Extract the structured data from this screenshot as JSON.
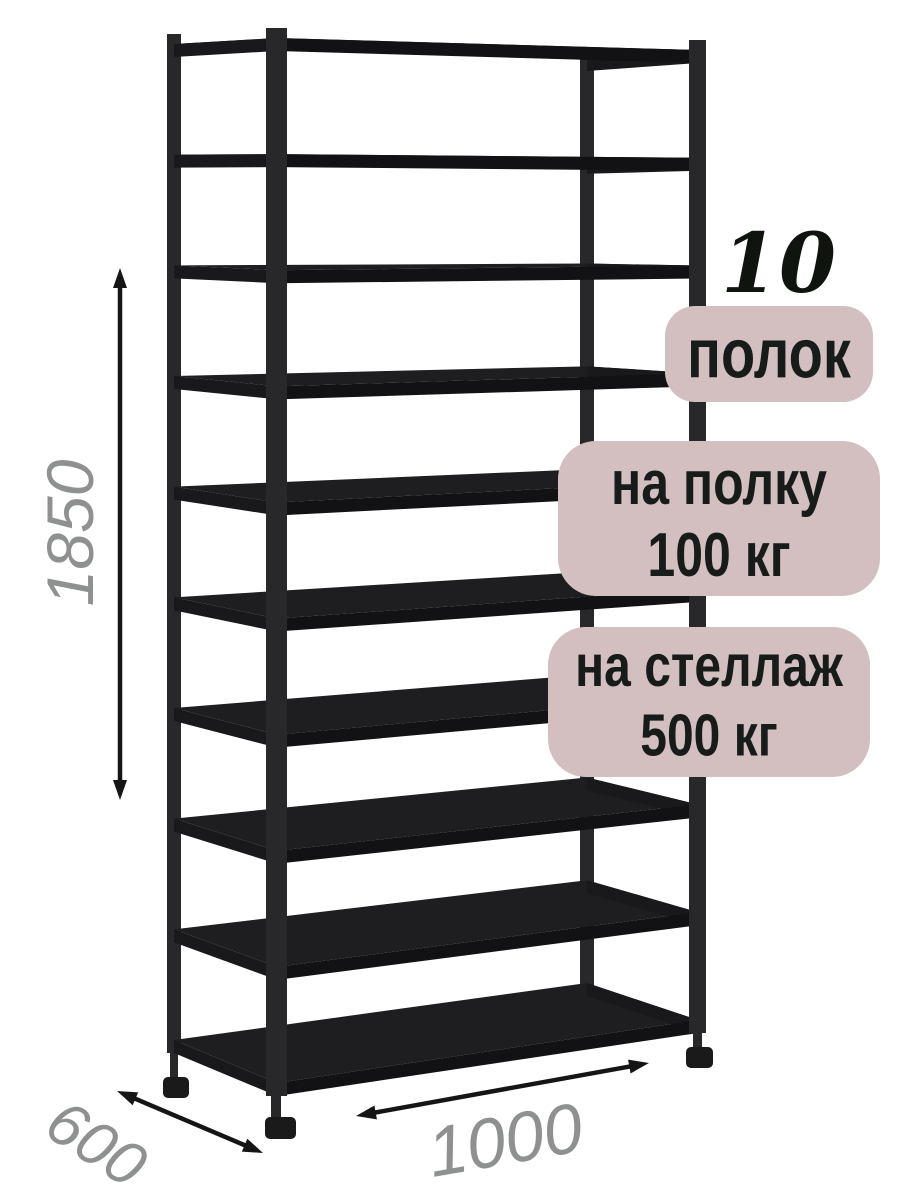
{
  "product": {
    "shelf_count": 10
  },
  "callouts": {
    "shelf_count_value": "10",
    "shelf_count_unit": "полок",
    "shelf_load": {
      "line1": "на полку",
      "line2": "100 кг"
    },
    "rack_load": {
      "line1": "на стеллаж",
      "line2": "500 кг"
    }
  },
  "dimensions": {
    "height": "1850",
    "depth": "600",
    "width": "1000"
  },
  "colors": {
    "background": "#ffffff",
    "badge_bg": "#d3bfc0",
    "badge_text": "#171b1a",
    "big_number": "#10140f",
    "dim_label": "#8f9191",
    "arrow": "#151515",
    "post": "#28282b",
    "shelf_top": "#1e1e21",
    "shelf_front": "#121214",
    "shelf_side": "#19191b",
    "foot": "#1a1a1b"
  }
}
